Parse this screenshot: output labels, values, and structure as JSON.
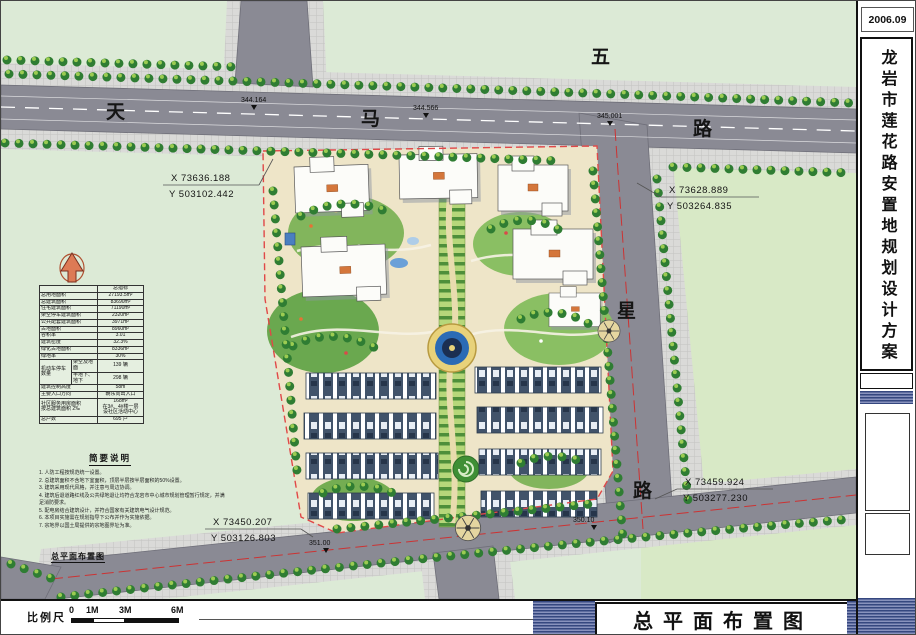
{
  "meta": {
    "date": "2006.09",
    "project_title": "龙岩市莲花路安置地规划设计方案"
  },
  "drawing": {
    "title_big": "总平面布置图",
    "title_small": "总平面布置图"
  },
  "roads": {
    "horizontal_name": "天马路",
    "vertical_name": "五星路"
  },
  "elevations": [
    "344.164",
    "344.566",
    "345.001",
    "351.00",
    "350.10"
  ],
  "coordinates": [
    {
      "x": "X 73636.188",
      "y": "Y 503102.442"
    },
    {
      "x": "X 73628.889",
      "y": "Y 503264.835"
    },
    {
      "x": "X 73459.924",
      "y": "Y 503277.230"
    },
    {
      "x": "X 73450.207",
      "y": "Y 503126.803"
    }
  ],
  "indicators": {
    "header": "总指标",
    "rows": [
      {
        "label": "总用地面积",
        "value": "27193.5m²"
      },
      {
        "label": "总建筑面积",
        "value": "83690m²"
      },
      {
        "label": "住宅建筑面积",
        "value": "71190m²"
      },
      {
        "label": "架空停车建筑面积",
        "value": "2320m²"
      },
      {
        "label": "公共配套建筑面积",
        "value": "3971m²"
      },
      {
        "label": "占地面积",
        "value": "8960m²"
      },
      {
        "label": "容积率",
        "value": "3.01"
      },
      {
        "label": "建筑密度",
        "value": "32.3%"
      },
      {
        "label": "绿化占地面积",
        "value": "8336m²"
      },
      {
        "label": "绿地率",
        "value": "30%"
      },
      {
        "label": "机动车停车数量",
        "sub": [
          {
            "label": "架空及地面",
            "value": "139 辆"
          },
          {
            "label": "半地下、地下",
            "value": "298 辆"
          }
        ]
      },
      {
        "label": "建筑控制高度",
        "value": "58m"
      },
      {
        "label": "主要入口方向",
        "value": "朝东向出入口"
      },
      {
        "label": "社区服务用房面积\n按总建筑面积 2‰",
        "value": "168m²\n在3#、4#楼一层\n设社区活动中心"
      },
      {
        "label": "总户数",
        "value": "695 户"
      }
    ]
  },
  "notes": {
    "title": "简要说明",
    "items": [
      "人防工程按规范统一设置。",
      "总建筑面积不含地下室面积，顶层半层按半层面积的50%设置。",
      "建筑采用现代风格，并注意与周边协调。",
      "建筑后退道路红线及公共绿地退让均符合龙岩市中心城市规划管理暂行规定，并满足消防要求。",
      "配电房结合建筑设计，并符合国家有关建筑电气设计规范。",
      "本项目实施需在规划指导下公布并作为实施依据。",
      "宗地界以国土局提供的宗地图界址为准。"
    ]
  },
  "scale": {
    "label": "比例尺",
    "ticks": [
      "0",
      "1M",
      "3M",
      "6M"
    ]
  },
  "colors": {
    "road": "#8a8a94",
    "site_boundary_red": "#e04848",
    "hatch_blue": "#35477f",
    "tree_green": "#2f7d33",
    "water_blue": "#2b6bb5",
    "paving_beige": "#eee5c8"
  }
}
